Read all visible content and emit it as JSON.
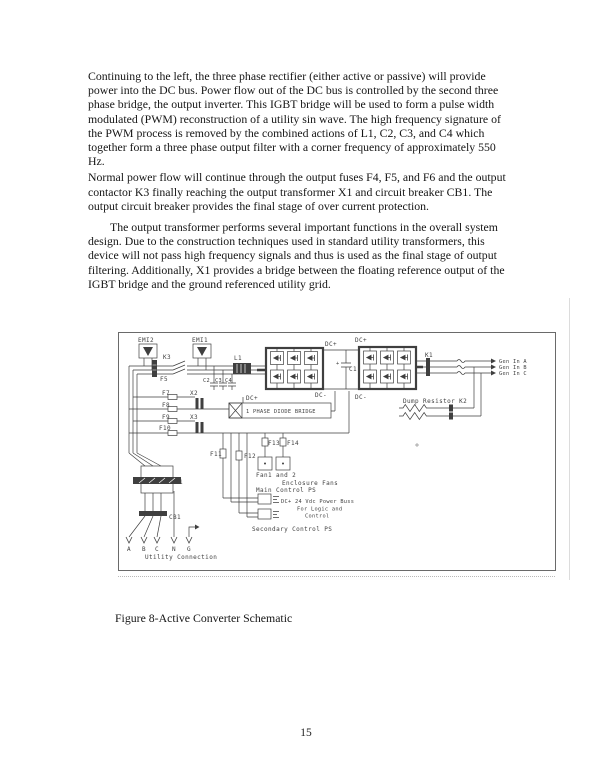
{
  "document": {
    "paragraphs": [
      {
        "lines": [
          "Continuing to the left, the three phase rectifier (either active or passive) will provide",
          "power into the DC bus.  Power flow out of the DC bus is controlled by the second three",
          "phase bridge, the output inverter.   This IGBT bridge will be used to form a pulse width",
          "modulated (PWM) reconstruction of a utility sin wave.  The high frequency signature of",
          "the PWM process is removed by the combined actions of L1, C2, C3, and C4 which",
          "together form a three phase output filter with a corner frequency of approximately 550",
          "Hz."
        ]
      },
      {
        "lines": [
          "Normal power flow will continue through the output fuses F4, F5, and F6 and the output",
          "contactor K3 finally reaching the output transformer X1 and circuit breaker CB1.  The",
          "output circuit breaker provides the final stage of over current protection."
        ]
      },
      {
        "lines": [
          "The output transformer performs several important functions in the overall system",
          "design.  Due to the construction techniques used in standard utility transformers, this",
          "device will not pass high frequency signals and thus is used as the final stage of output",
          "filtering.  Additionally, X1 provides a bridge between the floating reference output of the",
          "IGBT bridge and the ground referenced utility grid."
        ]
      }
    ],
    "figure_caption": "Figure 8-Active Converter Schematic",
    "page_number": "15"
  },
  "schematic": {
    "ink": "#3f3f3f",
    "labels": {
      "emi2": "EMI2",
      "emi1": "EMI1",
      "k3": "K3",
      "f5": "F5",
      "l1": "L1",
      "c2": "C2",
      "c3": "C3",
      "c4": "C4",
      "dc_plus_1": "DC+",
      "dc_plus_2": "DC+",
      "dc_minus_1": "DC-",
      "dc_minus_2": "DC-",
      "plus": "+",
      "c1": "C1",
      "k1": "K1",
      "gen_in_a": "Gen In A",
      "gen_in_b": "Gen In B",
      "gen_in_c": "Gen In C",
      "dump_resistor_k2": "Dump Resistor  K2",
      "f7": "F7",
      "x2": "X2",
      "dc_plus_aux": "DC+",
      "diode_bridge": "1 PHASE DIODE BRIDGE",
      "f8": "F8",
      "f9": "F9",
      "x3": "X3",
      "f10": "F10",
      "f11": "F11",
      "f12": "F12",
      "f13": "F13",
      "f14": "F14",
      "fans": "Fan1 and 2",
      "enclosure_fans": "Enclosure Fans",
      "main_control_ps": "Main Control PS",
      "power_buss": "DC+ 24 Vdc Power Buss",
      "power_buss_2": "For Logic and",
      "power_buss_3": "Control",
      "secondary_control_ps": "Secondary Control PS",
      "x1": "X1",
      "cb1": "CB1",
      "term_a": "A",
      "term_b": "B",
      "term_c": "C",
      "term_n": "N",
      "term_g": "G",
      "utility_connection": "Utility Connection"
    }
  }
}
